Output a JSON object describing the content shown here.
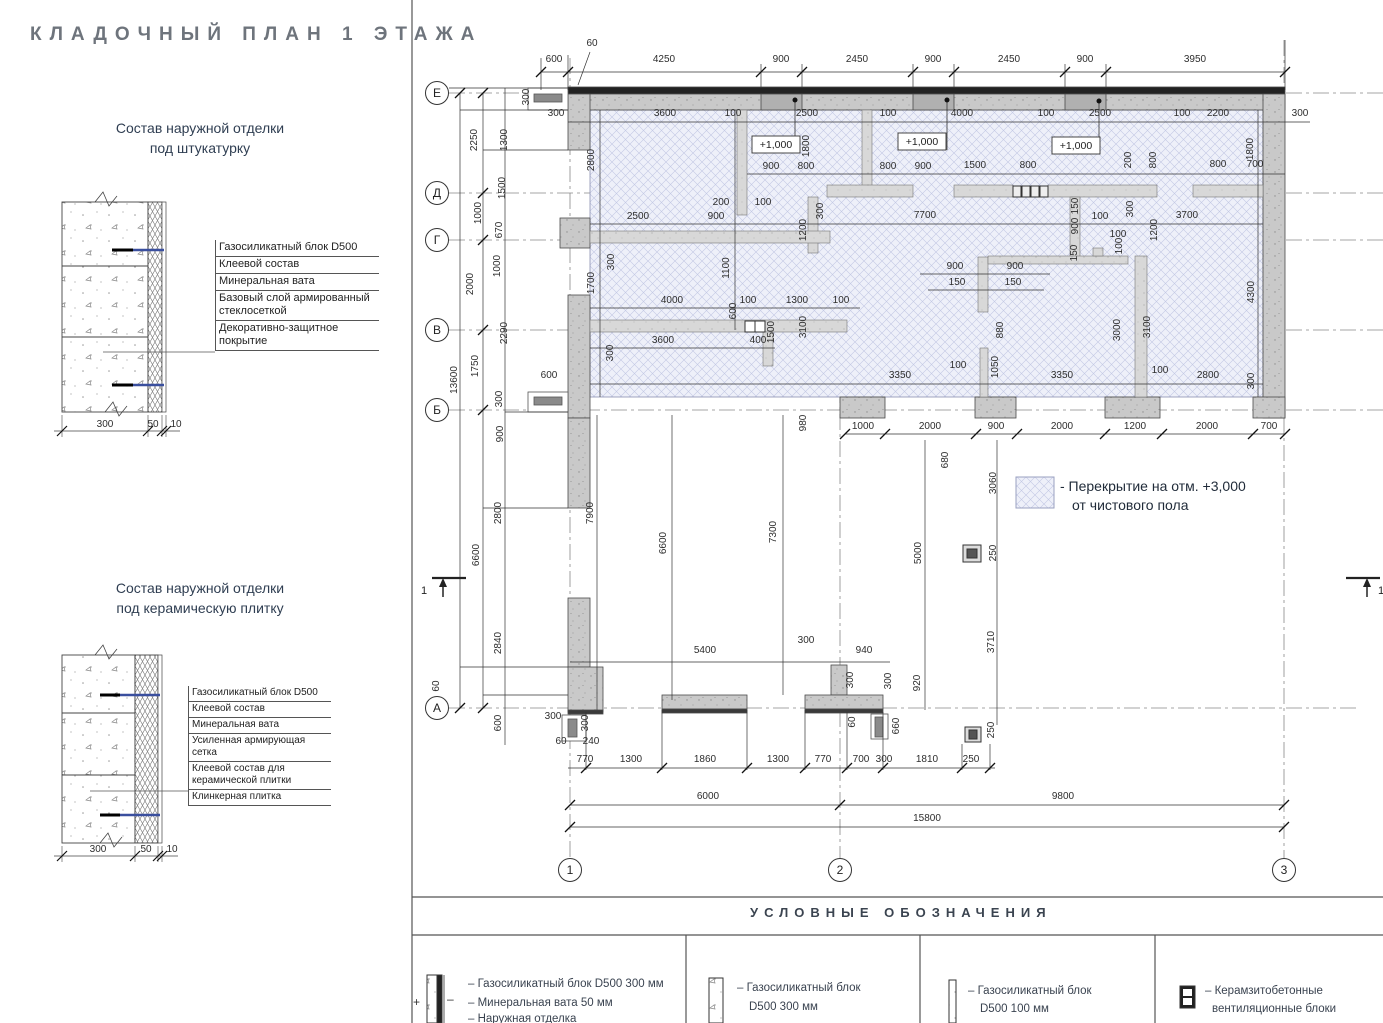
{
  "page_title": "КЛАДОЧНЫЙ ПЛАН 1 ЭТАЖА",
  "details": [
    {
      "title": [
        "Состав наружной отделки",
        "под штукатурку"
      ],
      "layers": [
        "Газосиликатный блок D500",
        "Клеевой состав",
        "Минеральная вата",
        "Базовый слой армированный стеклосеткой",
        "Декоративно-защитное покрытие"
      ],
      "dims": [
        "300",
        "50",
        "10"
      ]
    },
    {
      "title": [
        "Состав наружной отделки",
        "под керамическую плитку"
      ],
      "layers": [
        "Газосиликатный блок D500",
        "Клеевой состав",
        "Минеральная вата",
        "Усиленная армирующая сетка",
        "Клеевой состав для керамической плитки",
        "Клинкерная плитка"
      ],
      "dims": [
        "300",
        "50",
        "10"
      ]
    }
  ],
  "plan": {
    "row_axes": [
      [
        "Е",
        437,
        93
      ],
      [
        "Д",
        437,
        193
      ],
      [
        "Г",
        437,
        240
      ],
      [
        "В",
        437,
        330
      ],
      [
        "Б",
        437,
        410
      ],
      [
        "А",
        437,
        708
      ]
    ],
    "col_axes": [
      [
        "1",
        570,
        870
      ],
      [
        "2",
        840,
        870
      ],
      [
        "3",
        1284,
        870
      ]
    ],
    "section_label": "1",
    "note": [
      "- Перекрытие на отм. +3,000",
      "от чистового пола"
    ],
    "elevation_marks": [
      {
        "text": "+1,000",
        "box": [
          752,
          136,
          48,
          17
        ],
        "dot": [
          795,
          100
        ]
      },
      {
        "text": "+1,000",
        "box": [
          898,
          133,
          48,
          17
        ],
        "dot": [
          947,
          100
        ]
      },
      {
        "text": "+1,000",
        "box": [
          1052,
          137,
          48,
          17
        ],
        "dot": [
          1099,
          101
        ]
      }
    ],
    "dims": [
      [
        "60",
        592,
        46,
        0
      ],
      [
        "600",
        554,
        62,
        0
      ],
      [
        "4250",
        664,
        62,
        0
      ],
      [
        "900",
        781,
        62,
        0
      ],
      [
        "2450",
        857,
        62,
        0
      ],
      [
        "900",
        933,
        62,
        0
      ],
      [
        "2450",
        1009,
        62,
        0
      ],
      [
        "900",
        1085,
        62,
        0
      ],
      [
        "3950",
        1195,
        62,
        0
      ],
      [
        "300",
        529,
        97,
        1
      ],
      [
        "300",
        556,
        116,
        0
      ],
      [
        "3600",
        665,
        116,
        0
      ],
      [
        "100",
        733,
        116,
        0
      ],
      [
        "2500",
        807,
        116,
        0
      ],
      [
        "100",
        888,
        116,
        0
      ],
      [
        "4000",
        962,
        116,
        0
      ],
      [
        "100",
        1046,
        116,
        0
      ],
      [
        "2500",
        1100,
        116,
        0
      ],
      [
        "100",
        1182,
        116,
        0
      ],
      [
        "2200",
        1218,
        116,
        0
      ],
      [
        "300",
        1300,
        116,
        0
      ],
      [
        "2800",
        594,
        160,
        1
      ],
      [
        "1800",
        809,
        146,
        1
      ],
      [
        "200",
        1131,
        160,
        1
      ],
      [
        "800",
        1156,
        160,
        1
      ],
      [
        "1800",
        1253,
        149,
        1
      ],
      [
        "900",
        771,
        169,
        0
      ],
      [
        "800",
        806,
        169,
        0
      ],
      [
        "800",
        888,
        169,
        0
      ],
      [
        "900",
        923,
        169,
        0
      ],
      [
        "1500",
        975,
        168,
        0
      ],
      [
        "800",
        1028,
        168,
        0
      ],
      [
        "800",
        1218,
        167,
        0
      ],
      [
        "700",
        1255,
        167,
        0
      ],
      [
        "2250",
        477,
        140,
        1
      ],
      [
        "1300",
        507,
        140,
        1
      ],
      [
        "1500",
        505,
        188,
        1
      ],
      [
        "1000",
        481,
        213,
        1
      ],
      [
        "670",
        502,
        230,
        1
      ],
      [
        "1000",
        500,
        266,
        1
      ],
      [
        "2000",
        473,
        284,
        1
      ],
      [
        "2290",
        507,
        333,
        1
      ],
      [
        "1750",
        478,
        366,
        1
      ],
      [
        "13600",
        457,
        380,
        1
      ],
      [
        "300",
        502,
        399,
        1
      ],
      [
        "900",
        503,
        434,
        1
      ],
      [
        "6600",
        479,
        555,
        1
      ],
      [
        "2800",
        501,
        513,
        1
      ],
      [
        "2840",
        501,
        643,
        1
      ],
      [
        "60",
        439,
        686,
        1
      ],
      [
        "600",
        501,
        723,
        1
      ],
      [
        "200",
        721,
        205,
        0
      ],
      [
        "100",
        763,
        205,
        0
      ],
      [
        "2500",
        638,
        219,
        0
      ],
      [
        "900",
        716,
        219,
        0
      ],
      [
        "7700",
        925,
        218,
        0
      ],
      [
        "100",
        1100,
        219,
        0
      ],
      [
        "3700",
        1187,
        218,
        0
      ],
      [
        "300",
        823,
        211,
        1
      ],
      [
        "1200",
        806,
        230,
        1
      ],
      [
        "150",
        1078,
        206,
        1
      ],
      [
        "900",
        1078,
        226,
        1
      ],
      [
        "300",
        1133,
        209,
        1
      ],
      [
        "1200",
        1157,
        230,
        1
      ],
      [
        "100",
        1122,
        246,
        1
      ],
      [
        "150",
        1077,
        253,
        1
      ],
      [
        "300",
        614,
        262,
        1
      ],
      [
        "1700",
        594,
        283,
        1
      ],
      [
        "1100",
        729,
        268,
        1
      ],
      [
        "900",
        955,
        269,
        0
      ],
      [
        "900",
        1015,
        269,
        0
      ],
      [
        "150",
        957,
        285,
        0
      ],
      [
        "150",
        1013,
        285,
        0
      ],
      [
        "100",
        1118,
        237,
        0
      ],
      [
        "4000",
        672,
        303,
        0
      ],
      [
        "100",
        748,
        303,
        0
      ],
      [
        "1300",
        797,
        303,
        0
      ],
      [
        "100",
        841,
        303,
        0
      ],
      [
        "600",
        736,
        311,
        1
      ],
      [
        "1500",
        774,
        332,
        1
      ],
      [
        "3100",
        806,
        327,
        1
      ],
      [
        "880",
        1003,
        330,
        1
      ],
      [
        "3000",
        1120,
        330,
        1
      ],
      [
        "3100",
        1150,
        327,
        1
      ],
      [
        "4300",
        1254,
        292,
        1
      ],
      [
        "3600",
        663,
        343,
        0
      ],
      [
        "400",
        758,
        343,
        0
      ],
      [
        "300",
        613,
        353,
        1
      ],
      [
        "3350",
        900,
        378,
        0
      ],
      [
        "100",
        958,
        368,
        0
      ],
      [
        "1050",
        998,
        367,
        1
      ],
      [
        "3350",
        1062,
        378,
        0
      ],
      [
        "100",
        1160,
        373,
        0
      ],
      [
        "2800",
        1208,
        378,
        0
      ],
      [
        "300",
        1254,
        381,
        1
      ],
      [
        "600",
        549,
        378,
        0
      ],
      [
        "980",
        806,
        423,
        1
      ],
      [
        "1000",
        863,
        429,
        0
      ],
      [
        "2000",
        930,
        429,
        0
      ],
      [
        "900",
        996,
        429,
        0
      ],
      [
        "2000",
        1062,
        429,
        0
      ],
      [
        "1200",
        1135,
        429,
        0
      ],
      [
        "2000",
        1207,
        429,
        0
      ],
      [
        "700",
        1269,
        429,
        0
      ],
      [
        "680",
        948,
        460,
        1
      ],
      [
        "3060",
        996,
        483,
        1
      ],
      [
        "7900",
        593,
        513,
        1
      ],
      [
        "6600",
        666,
        543,
        1
      ],
      [
        "7300",
        776,
        532,
        1
      ],
      [
        "5000",
        921,
        553,
        1
      ],
      [
        "250",
        996,
        553,
        1
      ],
      [
        "3710",
        994,
        642,
        1
      ],
      [
        "300",
        806,
        643,
        0
      ],
      [
        "5400",
        705,
        653,
        0
      ],
      [
        "940",
        864,
        653,
        0
      ],
      [
        "300",
        853,
        680,
        1
      ],
      [
        "300",
        891,
        681,
        1
      ],
      [
        "920",
        920,
        683,
        1
      ],
      [
        "60",
        855,
        722,
        1
      ],
      [
        "660",
        899,
        726,
        1
      ],
      [
        "250",
        994,
        730,
        1
      ],
      [
        "300",
        553,
        719,
        0
      ],
      [
        "300",
        588,
        723,
        1
      ],
      [
        "60",
        561,
        744,
        0
      ],
      [
        "240",
        591,
        744,
        0
      ],
      [
        "770",
        585,
        762,
        0
      ],
      [
        "1300",
        631,
        762,
        0
      ],
      [
        "1860",
        705,
        762,
        0
      ],
      [
        "1300",
        778,
        762,
        0
      ],
      [
        "770",
        823,
        762,
        0
      ],
      [
        "700",
        861,
        762,
        0
      ],
      [
        "300",
        884,
        762,
        0
      ],
      [
        "1810",
        927,
        762,
        0
      ],
      [
        "250",
        971,
        762,
        0
      ],
      [
        "6000",
        708,
        799,
        0
      ],
      [
        "9800",
        1063,
        799,
        0
      ],
      [
        "15800",
        927,
        821,
        0
      ]
    ]
  },
  "legend": {
    "title": "УСЛОВНЫЕ ОБОЗНАЧЕНИЯ",
    "items": [
      {
        "lines": [
          "–  Газосиликатный блок D500 300 мм",
          "–  Минеральная вата 50 мм",
          "–  Наружная отделка"
        ]
      },
      {
        "lines": [
          "–  Газосиликатный блок",
          "D500 300 мм"
        ]
      },
      {
        "lines": [
          "–  Газосиликатный блок",
          "D500 100 мм"
        ]
      },
      {
        "lines": [
          "–  Керамзитобетонные",
          "вентиляционные блоки"
        ]
      }
    ],
    "marks": {
      "plus": "+",
      "minus": "–"
    }
  },
  "colors": {
    "hatch_fill": "#eef0f9",
    "hatch_line": "#c3c8e4",
    "wall": "#c9c9c9",
    "partition": "#d8d8d8",
    "dark_band": "#222222",
    "accent_blue": "#3a4f9e",
    "title": "#6e747c",
    "text": "#2d2d2d"
  }
}
